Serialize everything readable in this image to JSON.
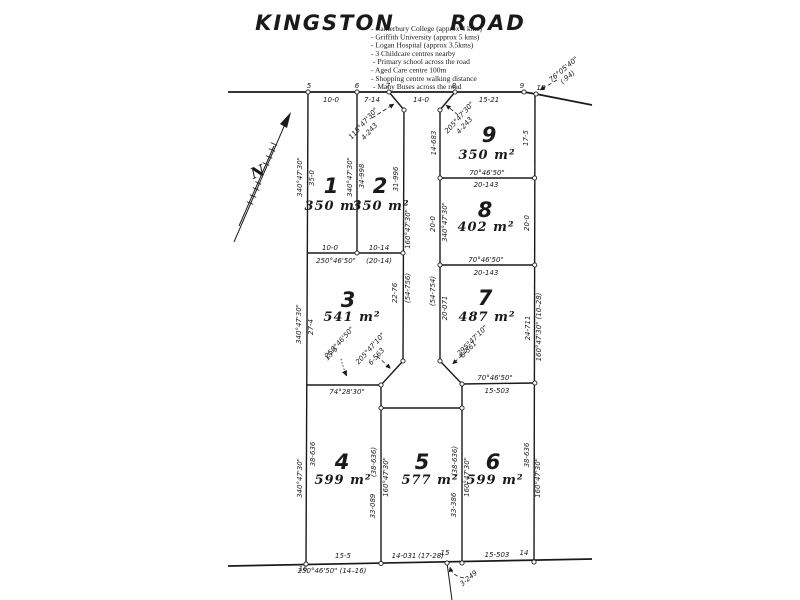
{
  "header": {
    "road_name_left": "KINGSTON",
    "road_name_right": "ROAD",
    "amenities": [
      "- Canterbury College (approx 4 kms)",
      "- Griffith University (approx 5 kms)",
      "- Logan Hospital (approx 3.5kms)",
      "- 3 Childcare centres nearby",
      "- Primary school across the road",
      "- Aged Care centre 100m",
      "- Shopping centre walking distance",
      "- Many Buses across the road"
    ]
  },
  "north": {
    "label": "N"
  },
  "lots": {
    "lot1": {
      "number": "1",
      "area": "350 m²"
    },
    "lot2": {
      "number": "2",
      "area": "350 m²"
    },
    "lot3": {
      "number": "3",
      "area": "541 m²"
    },
    "lot4": {
      "number": "4",
      "area": "599 m²"
    },
    "lot5": {
      "number": "5",
      "area": "577  m²"
    },
    "lot6": {
      "number": "6",
      "area": "599 m²"
    },
    "lot7": {
      "number": "7",
      "area": "487 m²"
    },
    "lot8": {
      "number": "8",
      "area": "402 m²"
    },
    "lot9": {
      "number": "9",
      "area": "350 m²"
    }
  },
  "points": {
    "p5": "5",
    "p6": "6",
    "p7": "7",
    "p8": "8",
    "p9": "9",
    "p10": "10",
    "p14": "14",
    "p15": "15",
    "p16": "16"
  },
  "dims": {
    "road_f1": "10-0",
    "road_f2": "7-14",
    "road_f3": "14-0",
    "road_f4": "15-21",
    "splay_left_b": "115°47'30\"",
    "splay_left_d": "4-243",
    "splay_right_b": "205°47'30\"",
    "splay_right_d": "4-243",
    "corner_tr_b": "76°05'40\"",
    "corner_tr_d": "(·94)",
    "lot1_left_b": "340°47'30\"",
    "lot1_left_d": "35-0",
    "div12_b": "340°47'30\"",
    "div12_d": "34-998",
    "lot2_right_d": "31-996",
    "corridor_left_b": "160°47'30\"",
    "corridor_left_total": "(54-756)",
    "lot3_right_d": "22-76",
    "lot9_left_d": "14-683",
    "corridor_right_b": "340°47'30\"",
    "lot8_left_d": "20-0",
    "corridor_right_total": "(54-754)",
    "lot7_left_d": "20-071",
    "lot9_right_d": "17-5",
    "lot8_right_d": "20-0",
    "lot7_right_d": "24-711",
    "right_b": "160°47'30\" (10–28)",
    "lot6_right_d": "38-636",
    "lot6_right_b": "160°47'30\"",
    "lot12_bottom_d1": "10-0",
    "lot12_bottom_d2": "10-14",
    "lot12_bottom_b": "250°46'50\"",
    "lot12_bottom_total": "(20-14)",
    "lot9_bottom_b": "70°46'50\"",
    "lot9_bottom_d": "20-143",
    "lot8_bottom_b": "70°46'50\"",
    "lot8_bottom_d": "20-143",
    "lot7_bottom_b": "70°46'50\"",
    "lot7_bottom_d": "15-503",
    "lot3_left_b": "340°47'30\"",
    "lot3_left_d": "27-4",
    "lot3_bottom_b": "74°28'30\"",
    "ann1_b": "250°46'50\"",
    "ann1_d": "15-5",
    "ann2_b": "205°47'10\"",
    "ann2_d": "6-563",
    "ann3_b": "295°47'10\"",
    "ann3_d": "6-561",
    "ann4_d": "3-249",
    "lot4_left_b": "340°47'30\"",
    "lot4_left_d": "38-636",
    "div45_total": "(38-636)",
    "div45_b": "160°47'30\"",
    "div45_d": "33-089",
    "div56_total": "(38-636)",
    "div56_b": "160°47'30\"",
    "div56_d": "33-386",
    "bottom_d4": "15-5",
    "bottom_b": "250°46'50\" (14–16)",
    "bottom_d5a": "14-031",
    "bottom_d5b": "(17-28)",
    "bottom_d6": "15-503"
  }
}
